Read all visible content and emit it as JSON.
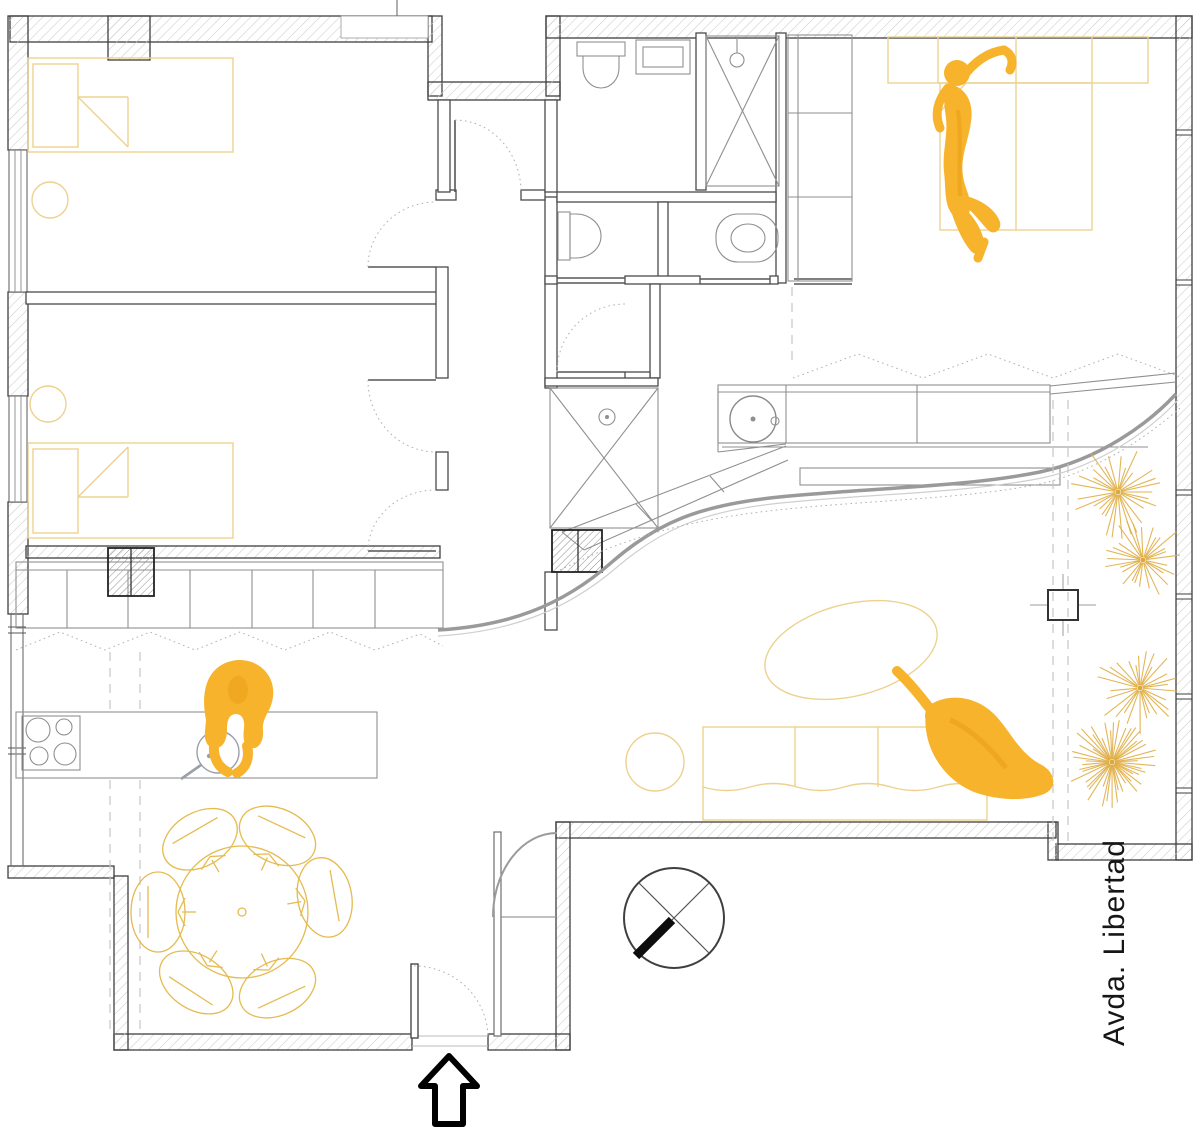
{
  "page": {
    "background": "#ffffff",
    "type": "architectural-floor-plan"
  },
  "street_label": "Avda. Libertad",
  "colors": {
    "wall_outline": "#3f3f3f",
    "wall_hatch": "#cccccc",
    "secondary_gray": "#9b9b9b",
    "light_gray": "#c4c4c4",
    "furniture_yellow": "#edd28f",
    "dining_yellow": "#e5bb4f",
    "figure_yellow": "#f6b32b",
    "figure_shade": "#e89c14",
    "plant_yellow": "#dfae45",
    "ink": "#161616"
  },
  "annotations": {
    "north_symbol": "circle-cross-compass",
    "entrance_symbol": "up-arrow"
  },
  "figures": [
    {
      "name": "person-lying-on-bed"
    },
    {
      "name": "person-cooking-at-counter"
    },
    {
      "name": "person-sitting-on-sofa"
    }
  ],
  "terrace": {
    "plants": [
      {
        "cx": 1118,
        "cy": 492,
        "r": 48,
        "rays": 30,
        "seed": 1
      },
      {
        "cx": 1143,
        "cy": 560,
        "r": 44,
        "rays": 28,
        "seed": 2
      },
      {
        "cx": 1140,
        "cy": 688,
        "r": 46,
        "rays": 28,
        "seed": 3
      },
      {
        "cx": 1112,
        "cy": 762,
        "r": 46,
        "rays": 48,
        "seed": 4
      }
    ]
  },
  "dining": {
    "cx": 242,
    "cy": 912,
    "table_r": 66,
    "chair_dist": 84,
    "chair_rx": 40,
    "chair_ry": 27,
    "chair_angles": [
      -120,
      -65,
      -10,
      65,
      123,
      180
    ],
    "chairs": 6
  }
}
